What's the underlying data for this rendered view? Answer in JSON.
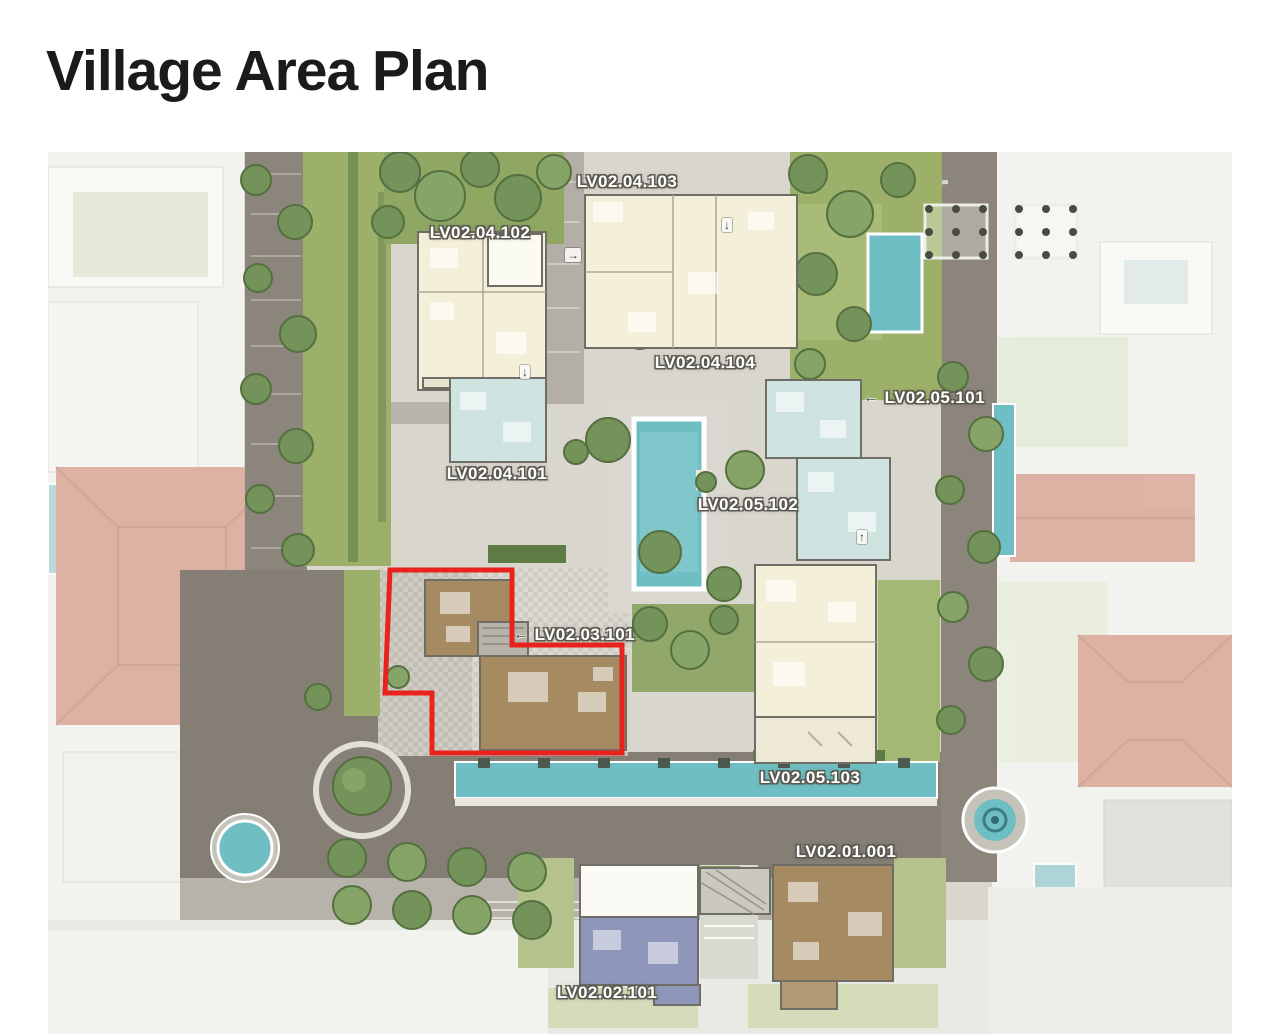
{
  "page": {
    "title": "Village Area Plan"
  },
  "map": {
    "description": "Top-down village site plan with villa floor plans, gardens, pools and stone roads",
    "highlight": {
      "unit": "LV02.03.101",
      "color": "#e8231d"
    },
    "colors": {
      "pool": "#6fbec3",
      "road": "#8b857c",
      "plaza": "#847e75",
      "lawn": "#9db069",
      "building_cream": "#f4efd9",
      "building_mint": "#cfe3e1",
      "building_blue": "#8e96ba",
      "building_brown": "#a58a62",
      "neighbor_roof": "#d9a392"
    },
    "icons": {
      "left_arrow": "←",
      "right_arrow": "→",
      "up_arrow": "↑",
      "down_arrow": "↓"
    },
    "labels": [
      {
        "text": "LV02.04.103",
        "arrow": ""
      },
      {
        "text": "LV02.04.102",
        "arrow": ""
      },
      {
        "text": "LV02.04.104",
        "arrow": ""
      },
      {
        "text": "LV02.05.101",
        "arrow": "←"
      },
      {
        "text": "LV02.04.101",
        "arrow": ""
      },
      {
        "text": "LV02.05.102",
        "arrow": ""
      },
      {
        "text": "LV02.03.101",
        "arrow": "←"
      },
      {
        "text": "LV02.05.103",
        "arrow": ""
      },
      {
        "text": "LV02.01.001",
        "arrow": ""
      },
      {
        "text": "LV02.02.101",
        "arrow": ""
      }
    ]
  }
}
